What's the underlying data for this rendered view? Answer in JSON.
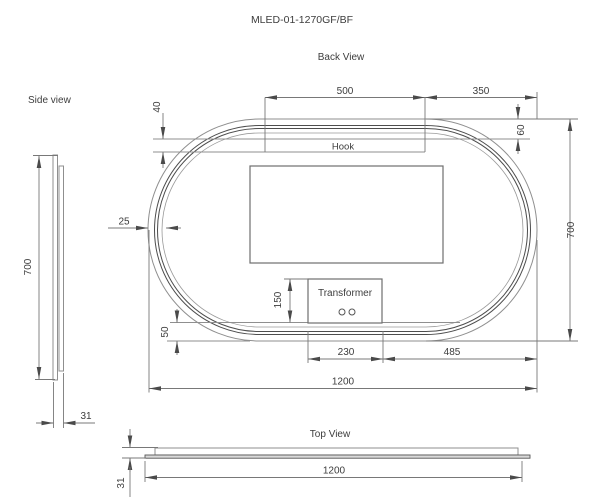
{
  "drawing": {
    "title": "MLED-01-1270GF/BF",
    "back_view": {
      "label": "Back View",
      "hook_label": "Hook",
      "transformer_label": "Transformer",
      "dim_hook_length": "500",
      "dim_top_right": "350",
      "dim_hook_height": "40",
      "dim_top_edge_offset": "60",
      "dim_frame_thickness": "25",
      "dim_height": "700",
      "dim_transformer_height": "150",
      "dim_bottom_offset": "50",
      "dim_transformer_width": "230",
      "dim_transformer_to_edge": "485",
      "dim_width": "1200"
    },
    "side_view": {
      "label": "Side view",
      "dim_height": "700",
      "dim_thickness": "31"
    },
    "top_view": {
      "label": "Top View",
      "dim_width": "1200",
      "dim_thickness": "31"
    }
  }
}
